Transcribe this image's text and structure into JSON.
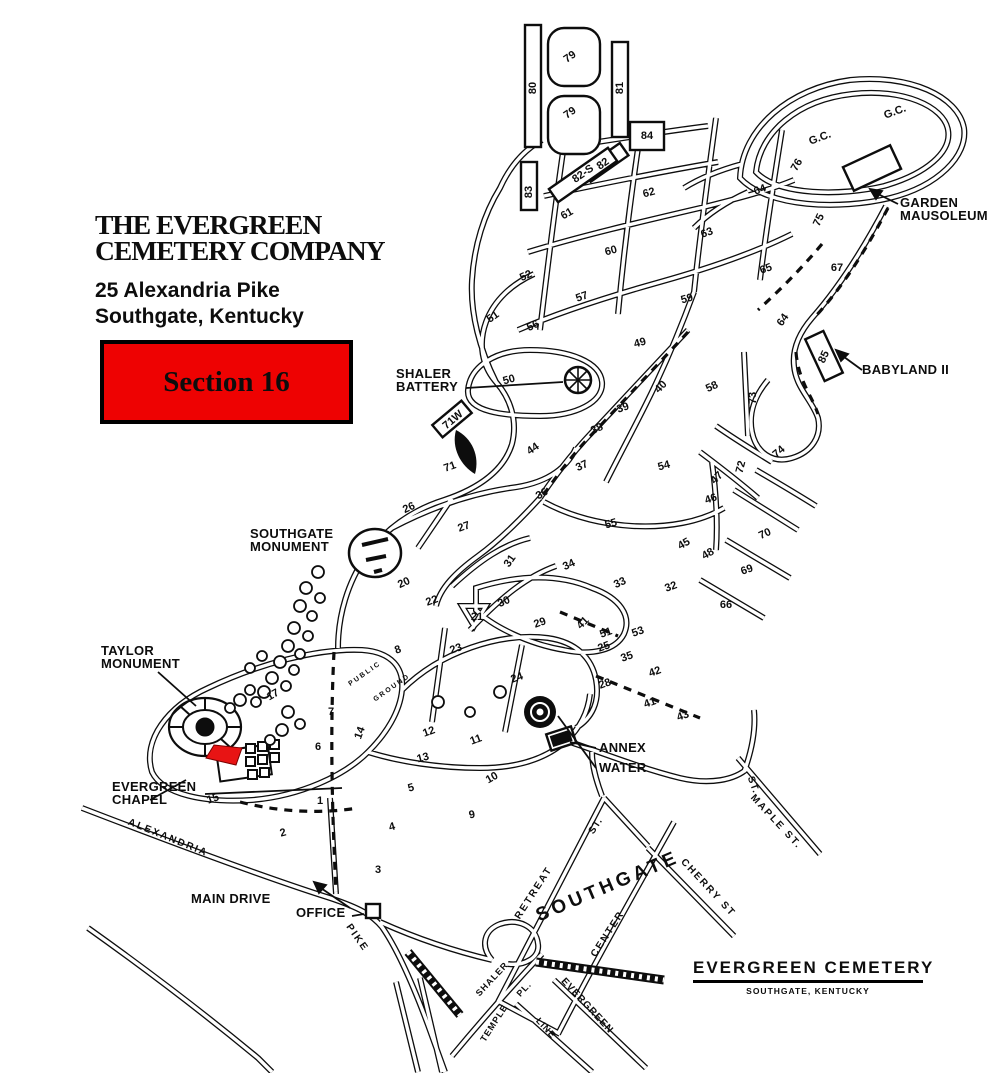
{
  "header": {
    "company_line1": "THE EVERGREEN",
    "company_line2": "CEMETERY COMPANY",
    "address_line1": "25 Alexandria Pike",
    "address_line2": "Southgate, Kentucky"
  },
  "section_callout": {
    "label": "Section 16",
    "bg_color": "#ee0202",
    "border_color": "#000000"
  },
  "highlighted_section": {
    "label": "16",
    "color": "#e81414"
  },
  "footer": {
    "title": "EVERGREEN  CEMETERY",
    "subtitle": "SOUTHGATE, KENTUCKY"
  },
  "map": {
    "sections": [
      [
        "80",
        533,
        88,
        -90
      ],
      [
        "79",
        570,
        57,
        -35
      ],
      [
        "79",
        570,
        113,
        -35
      ],
      [
        "81",
        620,
        88,
        -90
      ],
      [
        "84",
        647,
        136,
        0
      ],
      [
        "82",
        603,
        164,
        -35
      ],
      [
        "82-S",
        583,
        174,
        -35
      ],
      [
        "83",
        529,
        192,
        -90
      ],
      [
        "62",
        649,
        193,
        -15
      ],
      [
        "G.C.",
        820,
        138,
        -20
      ],
      [
        "G.C.",
        895,
        112,
        -20
      ],
      [
        "76",
        797,
        165,
        -60
      ],
      [
        "64",
        760,
        190,
        -20
      ],
      [
        "61",
        567,
        214,
        -30
      ],
      [
        "63",
        707,
        233,
        -20
      ],
      [
        "60",
        611,
        251,
        -15
      ],
      [
        "75",
        819,
        220,
        -65
      ],
      [
        "52",
        526,
        276,
        -25
      ],
      [
        "57",
        582,
        297,
        -20
      ],
      [
        "59",
        687,
        299,
        -15
      ],
      [
        "65",
        766,
        269,
        -20
      ],
      [
        "67",
        837,
        268,
        0
      ],
      [
        "64",
        783,
        320,
        -55
      ],
      [
        "51",
        493,
        317,
        -35
      ],
      [
        "56",
        533,
        326,
        -25
      ],
      [
        "49",
        640,
        343,
        -15
      ],
      [
        "85",
        824,
        357,
        -65
      ],
      [
        "50",
        509,
        380,
        -15
      ],
      [
        "40",
        661,
        387,
        -45
      ],
      [
        "39",
        623,
        408,
        -20
      ],
      [
        "58",
        712,
        387,
        -25
      ],
      [
        "73",
        753,
        398,
        -90
      ],
      [
        "71W",
        453,
        420,
        -40
      ],
      [
        "44",
        533,
        449,
        -35
      ],
      [
        "38",
        597,
        429,
        -25
      ],
      [
        "37",
        582,
        466,
        -25
      ],
      [
        "54",
        664,
        466,
        -15
      ],
      [
        "47",
        717,
        478,
        -45
      ],
      [
        "72",
        741,
        467,
        -75
      ],
      [
        "74",
        779,
        452,
        -40
      ],
      [
        "71",
        450,
        467,
        -20
      ],
      [
        "36",
        542,
        494,
        -30
      ],
      [
        "46",
        711,
        499,
        -20
      ],
      [
        "55",
        611,
        524,
        -15
      ],
      [
        "70",
        765,
        534,
        -25
      ],
      [
        "26",
        409,
        508,
        -25
      ],
      [
        "27",
        464,
        527,
        -20
      ],
      [
        "45",
        684,
        544,
        -30
      ],
      [
        "48",
        708,
        554,
        -30
      ],
      [
        "31",
        510,
        561,
        -55
      ],
      [
        "34",
        569,
        565,
        -25
      ],
      [
        "69",
        747,
        570,
        -20
      ],
      [
        "20",
        404,
        583,
        -25
      ],
      [
        "22",
        432,
        601,
        -20
      ],
      [
        "30",
        504,
        602,
        -25
      ],
      [
        "33",
        620,
        583,
        -25
      ],
      [
        "32",
        671,
        587,
        -20
      ],
      [
        "66",
        726,
        605,
        0
      ],
      [
        "29",
        540,
        623,
        -20
      ],
      [
        "21",
        477,
        617,
        0
      ],
      [
        "41",
        583,
        623,
        -45
      ],
      [
        "53",
        638,
        632,
        -20
      ],
      [
        "51",
        606,
        633,
        -20
      ],
      [
        "25",
        604,
        647,
        -20
      ],
      [
        "35",
        627,
        657,
        -20
      ],
      [
        "42",
        655,
        672,
        -20
      ],
      [
        "28",
        605,
        684,
        -20
      ],
      [
        "41",
        650,
        703,
        -20
      ],
      [
        "43",
        683,
        716,
        -20
      ],
      [
        "23",
        456,
        649,
        -20
      ],
      [
        "24",
        517,
        678,
        -20
      ],
      [
        "8",
        398,
        650,
        -20
      ],
      [
        "17",
        273,
        695,
        -30
      ],
      [
        "7",
        331,
        712,
        0
      ],
      [
        "14",
        360,
        733,
        -70
      ],
      [
        "6",
        318,
        747,
        0
      ],
      [
        "12",
        429,
        732,
        -20
      ],
      [
        "11",
        476,
        740,
        -20
      ],
      [
        "13",
        423,
        758,
        -15
      ],
      [
        "10",
        492,
        778,
        -30
      ],
      [
        "5",
        411,
        788,
        -15
      ],
      [
        "9",
        472,
        815,
        -10
      ],
      [
        "4",
        392,
        827,
        -15
      ],
      [
        "15",
        213,
        799,
        -20
      ],
      [
        "1",
        320,
        801,
        0
      ],
      [
        "2",
        283,
        833,
        -15
      ],
      [
        "3",
        378,
        870,
        0
      ]
    ],
    "landmarks": [
      {
        "name": "shaler-battery",
        "lines": [
          "SHALER",
          "BATTERY"
        ],
        "x": 396,
        "y": 367
      },
      {
        "name": "garden-mausoleum",
        "lines": [
          "GARDEN",
          "MAUSOLEUM"
        ],
        "x": 900,
        "y": 196
      },
      {
        "name": "babyland",
        "lines": [
          "BABYLAND II"
        ],
        "x": 862,
        "y": 363
      },
      {
        "name": "southgate-monument",
        "lines": [
          "SOUTHGATE",
          "MONUMENT"
        ],
        "x": 250,
        "y": 527
      },
      {
        "name": "taylor-monument",
        "lines": [
          "TAYLOR",
          "MONUMENT"
        ],
        "x": 101,
        "y": 644
      },
      {
        "name": "evergreen-chapel",
        "lines": [
          "EVERGREEN",
          "CHAPEL"
        ],
        "x": 112,
        "y": 780
      },
      {
        "name": "annex",
        "lines": [
          "ANNEX"
        ],
        "x": 599,
        "y": 741
      },
      {
        "name": "water",
        "lines": [
          "WATER"
        ],
        "x": 599,
        "y": 761
      },
      {
        "name": "main-drive",
        "lines": [
          "MAIN DRIVE"
        ],
        "x": 191,
        "y": 892
      },
      {
        "name": "office",
        "lines": [
          "OFFICE"
        ],
        "x": 296,
        "y": 906
      }
    ],
    "streets": [
      [
        "ALEXANDRIA",
        168,
        838,
        22,
        10,
        2
      ],
      [
        "PIKE",
        357,
        938,
        55,
        10,
        2
      ],
      [
        "RETREAT",
        534,
        893,
        -57,
        10,
        2
      ],
      [
        "ST.",
        596,
        826,
        -57,
        10,
        1
      ],
      [
        "SOUTHGATE",
        608,
        887,
        -23,
        19,
        4
      ],
      [
        "CENTER",
        608,
        934,
        -57,
        10,
        2
      ],
      [
        "CHERRY ST",
        708,
        888,
        47,
        10,
        2
      ],
      [
        "MAPLE ST.",
        776,
        822,
        47,
        10,
        2
      ],
      [
        "ST.",
        753,
        785,
        70,
        10,
        1
      ],
      [
        "SHALER",
        492,
        979,
        -47,
        9,
        1
      ],
      [
        "PL.",
        524,
        989,
        -47,
        9,
        1
      ],
      [
        "TEMPLE",
        494,
        1023,
        -57,
        9,
        1
      ],
      [
        "LINE",
        546,
        1028,
        47,
        9,
        1
      ],
      [
        "EVERGREEN",
        587,
        1006,
        47,
        10,
        1
      ],
      [
        "PUBLIC",
        365,
        674,
        -35,
        7,
        2
      ],
      [
        "GROUND",
        392,
        688,
        -35,
        7,
        2
      ]
    ]
  }
}
